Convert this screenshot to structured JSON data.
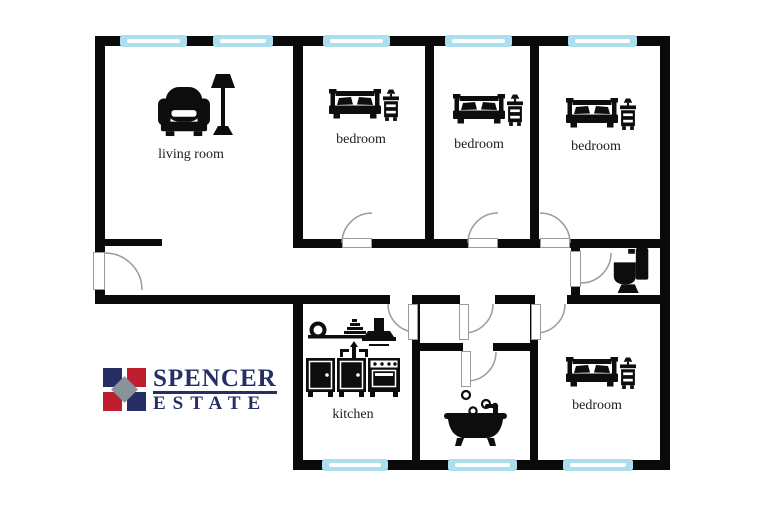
{
  "colors": {
    "wall": "#0a0a0a",
    "floor": "#ffffff",
    "window": "#abdfee",
    "window_line": "#ffffff",
    "door": "#9b9b9b",
    "icon": "#0d0d0d",
    "label": "#1c1c1c",
    "logo_navy": "#252f66",
    "logo_red": "#c01e2e",
    "logo_gray": "#87929a"
  },
  "rooms": {
    "living_room": {
      "label": "living room",
      "icons": [
        "armchair-icon",
        "floor-lamp-icon"
      ]
    },
    "bedroom_top_1": {
      "label": "bedroom",
      "icons": [
        "double-bed-icon",
        "nightstand-lamp-icon"
      ]
    },
    "bedroom_top_2": {
      "label": "bedroom",
      "icons": [
        "double-bed-icon",
        "nightstand-lamp-icon"
      ]
    },
    "bedroom_top_3": {
      "label": "bedroom",
      "icons": [
        "double-bed-icon",
        "nightstand-lamp-icon"
      ]
    },
    "bedroom_bottom": {
      "label": "bedroom",
      "icons": [
        "double-bed-icon",
        "nightstand-lamp-icon"
      ]
    },
    "kitchen": {
      "label": "kitchen",
      "icons": [
        "pot-roll-icon",
        "steamer-icon",
        "range-hood-icon",
        "sink-faucet-icon",
        "cabinets-stove-icon"
      ]
    },
    "bathroom": {
      "icons": [
        "bubbles-icon",
        "bathtub-icon"
      ]
    },
    "toilet": {
      "icons": [
        "toilet-icon"
      ]
    }
  },
  "branding": {
    "line1": "SPENCER",
    "line2": "ESTATE"
  }
}
